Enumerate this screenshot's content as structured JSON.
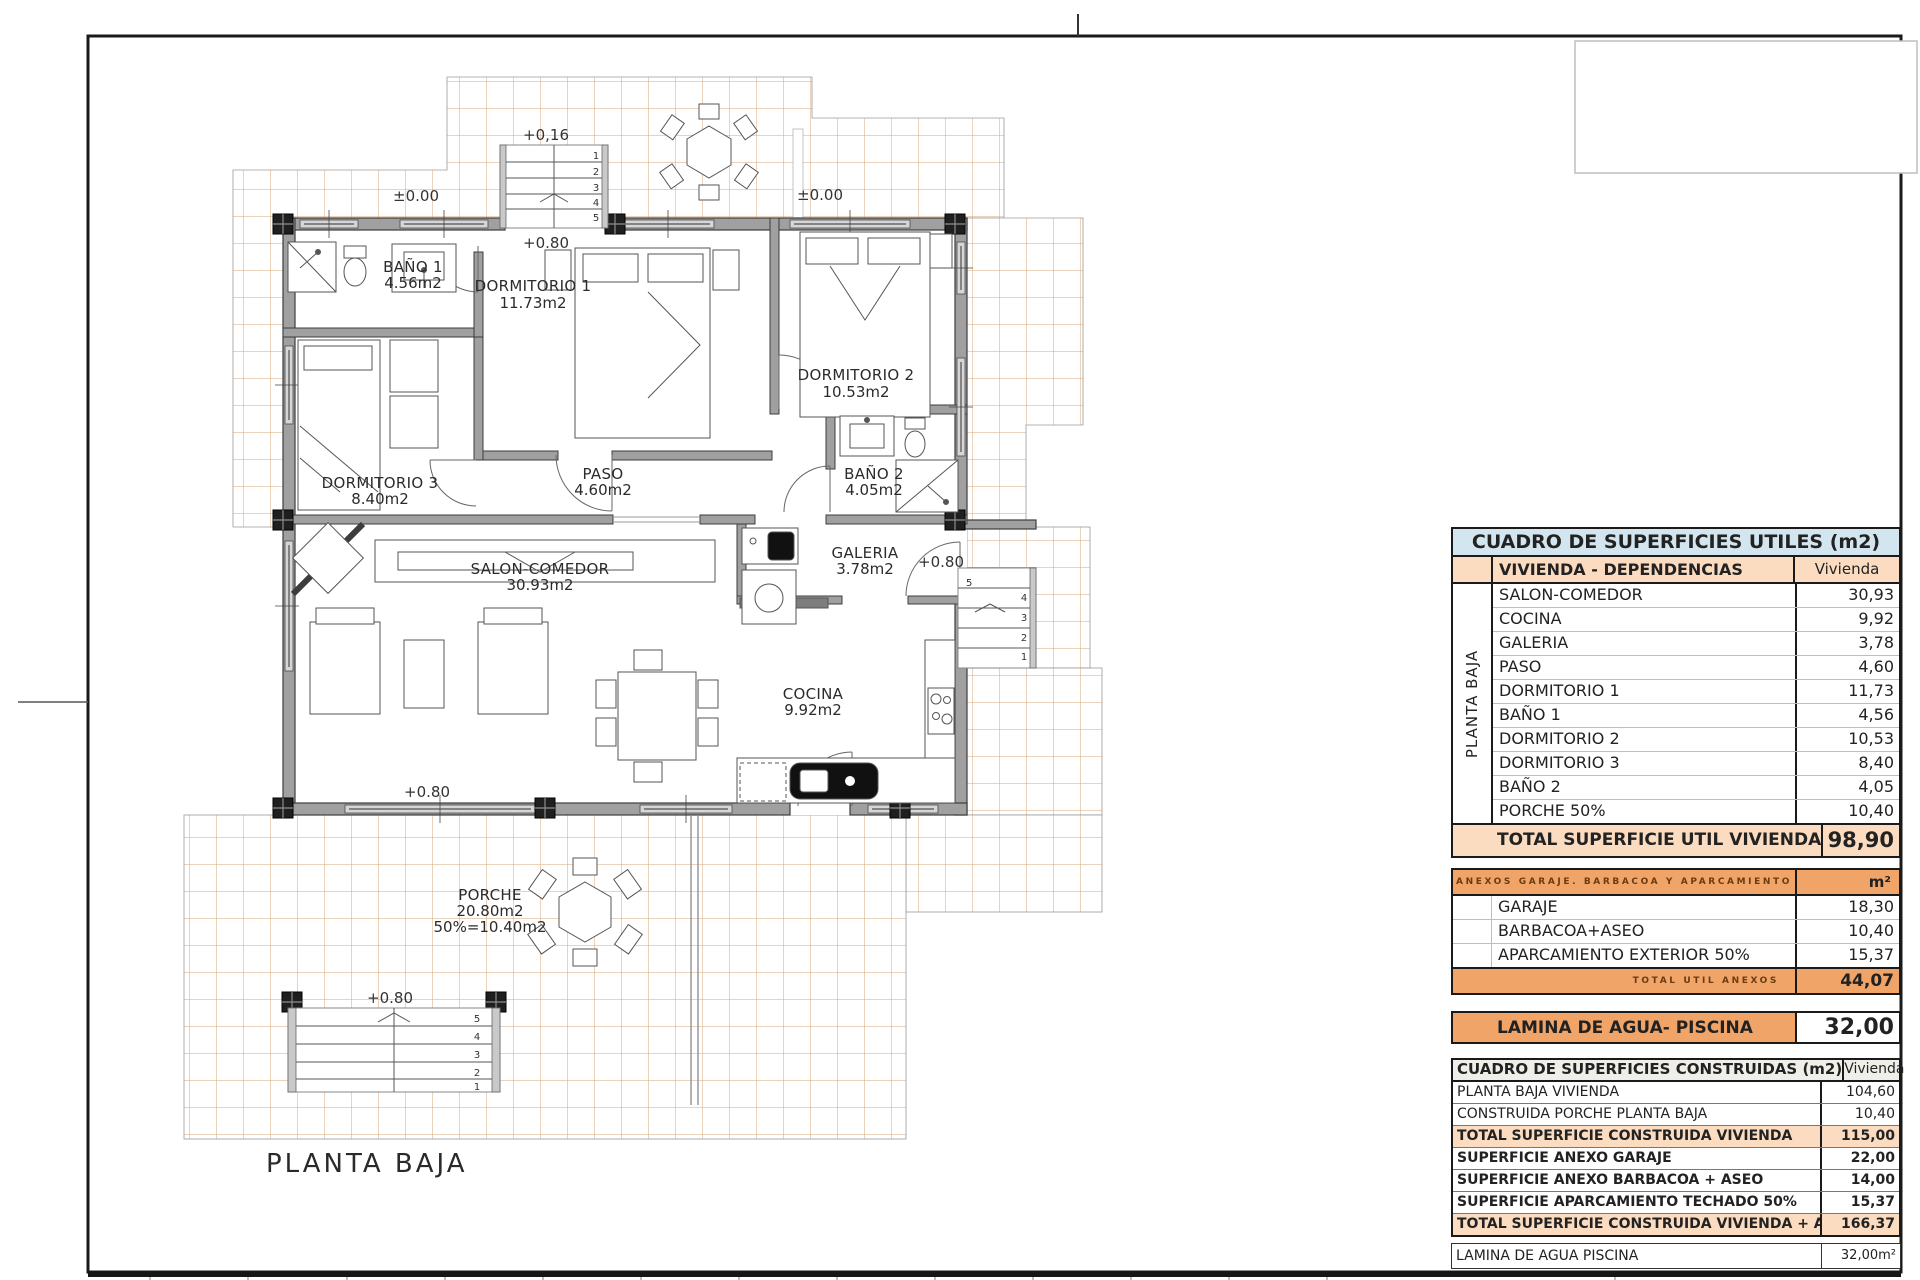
{
  "plan": {
    "title": "PLANTA BAJA",
    "rooms": [
      {
        "name": "BAÑO 1",
        "area": "4.56m2"
      },
      {
        "name": "DORMITORIO 1",
        "area": "11.73m2"
      },
      {
        "name": "DORMITORIO 2",
        "area": "10.53m2"
      },
      {
        "name": "DORMITORIO 3",
        "area": "8.40m2"
      },
      {
        "name": "PASO",
        "area": "4.60m2"
      },
      {
        "name": "BAÑO 2",
        "area": "4.05m2"
      },
      {
        "name": "SALON-COMEDOR",
        "area": "30.93m2"
      },
      {
        "name": "GALERIA",
        "area": "3.78m2"
      },
      {
        "name": "COCINA",
        "area": "9.92m2"
      },
      {
        "name": "PORCHE",
        "area": "20.80m2",
        "area2": "50%=10.40m2"
      }
    ],
    "levels": {
      "entry_top": "+0,16",
      "zero_left": "±0.00",
      "zero_right": "±0.00",
      "entry_door": "+0.80",
      "galeria": "+0.80",
      "salon": "+0.80",
      "porch_stairs": "+0.80"
    },
    "stairs": {
      "top": [
        "1",
        "2",
        "3",
        "4",
        "5"
      ],
      "right": [
        "5",
        "4",
        "3",
        "2",
        "1"
      ],
      "bottom": [
        "5",
        "4",
        "3",
        "2",
        "1"
      ]
    }
  },
  "tables": {
    "utiles": {
      "title": "CUADRO DE SUPERFICIES UTILES (m2)",
      "group": "PLANTA BAJA",
      "col_label": "VIVIENDA - DEPENDENCIAS",
      "col_value": "Vivienda",
      "rows": [
        {
          "label": "SALON-COMEDOR",
          "value": "30,93"
        },
        {
          "label": "COCINA",
          "value": "9,92"
        },
        {
          "label": "GALERIA",
          "value": "3,78"
        },
        {
          "label": "PASO",
          "value": "4,60"
        },
        {
          "label": "DORMITORIO 1",
          "value": "11,73"
        },
        {
          "label": "BAÑO 1",
          "value": "4,56"
        },
        {
          "label": "DORMITORIO 2",
          "value": "10,53"
        },
        {
          "label": "DORMITORIO 3",
          "value": "8,40"
        },
        {
          "label": "BAÑO 2",
          "value": "4,05"
        },
        {
          "label": "PORCHE 50%",
          "value": "10,40"
        }
      ],
      "total_label": "TOTAL SUPERFICIE UTIL VIVIENDA",
      "total_value": "98,90"
    },
    "anexos": {
      "title": "ANEXOS GARAJE. BARBACOA Y APARCAMIENTO",
      "col_value": "m²",
      "rows": [
        {
          "label": "GARAJE",
          "value": "18,30"
        },
        {
          "label": "BARBACOA+ASEO",
          "value": "10,40"
        },
        {
          "label": "APARCAMIENTO EXTERIOR 50%",
          "value": "15,37"
        }
      ],
      "total_label": "TOTAL UTIL ANEXOS",
      "total_value": "44,07"
    },
    "piscina_util": {
      "label": "LAMINA DE AGUA- PISCINA",
      "value": "32,00"
    },
    "construidas": {
      "title": "CUADRO DE SUPERFICIES CONSTRUIDAS (m2)",
      "col_value": "Vivienda",
      "rows": [
        {
          "label": "PLANTA BAJA VIVIENDA",
          "value": "104,60"
        },
        {
          "label": "CONSTRUIDA PORCHE PLANTA BAJA",
          "value": "10,40"
        },
        {
          "label": "TOTAL SUPERFICIE CONSTRUIDA VIVIENDA",
          "value": "115,00"
        },
        {
          "label": "SUPERFICIE ANEXO GARAJE",
          "value": "22,00"
        },
        {
          "label": "SUPERFICIE ANEXO BARBACOA + ASEO",
          "value": "14,00"
        },
        {
          "label": "SUPERFICIE APARCAMIENTO TECHADO 50%",
          "value": "15,37"
        },
        {
          "label": "TOTAL SUPERFICIE CONSTRUIDA VIVIENDA + ANEXOS",
          "value": "166,37"
        }
      ]
    },
    "piscina_construida": {
      "label": "LAMINA DE AGUA PISCINA",
      "value": "32,00m²"
    }
  },
  "colors": {
    "header_blue": "#d3e6f0",
    "peach": "#fbdcc1",
    "orange": "#f0a468",
    "tile_line": "#c6854e"
  }
}
